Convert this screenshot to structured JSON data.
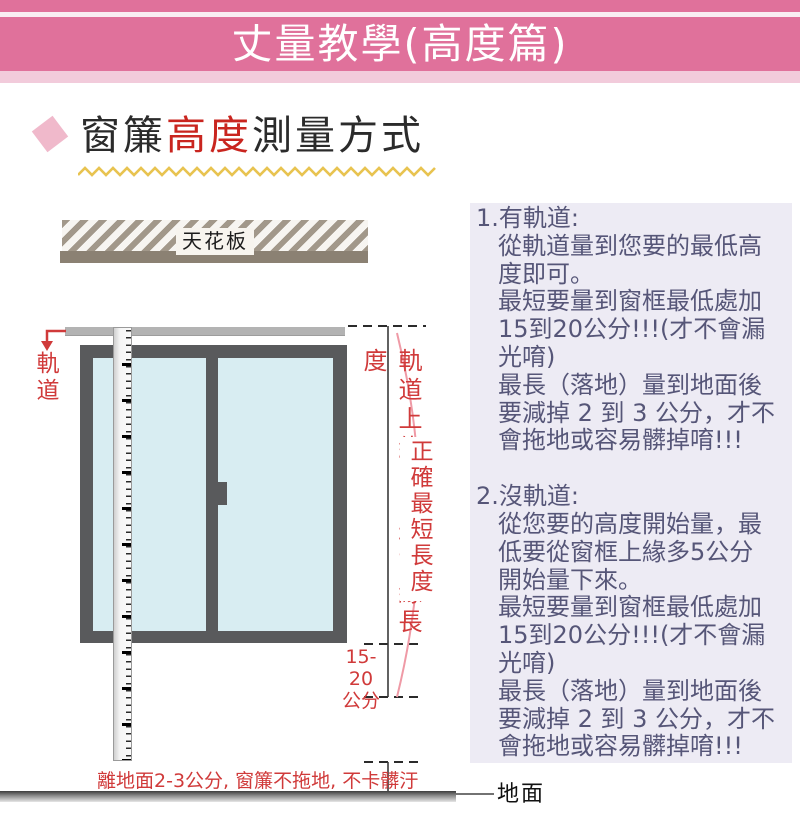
{
  "banner": {
    "title": "丈量教學(高度篇)"
  },
  "heading": {
    "part1": "窗簾",
    "highlight": "高度",
    "part2": "測量方式"
  },
  "diagram": {
    "ceiling_label": "天花板",
    "track_label": "軌道",
    "measure_left_label": "軌道上緣到窗框下緣長度",
    "measure_right_label": "正確最短長度",
    "gap_label_line1": "15-20",
    "gap_label_line2": "公分",
    "floor_note": "離地面2-3公分, 窗簾不拖地, 不卡髒汙",
    "ground_label": "地面"
  },
  "instructions": {
    "section1": {
      "heading": "1.有軌道:",
      "lines": [
        "從軌道量到您要的最低高",
        "度即可。",
        "最短要量到窗框最低處加",
        "15到20公分!!!(才不會漏",
        "光唷)",
        "最長（落地）量到地面後",
        "要減掉 2 到 3 公分，才不",
        "會拖地或容易髒掉唷!!!"
      ]
    },
    "section2": {
      "heading": "2.沒軌道:",
      "lines": [
        "從您要的高度開始量，最",
        "低要從窗框上緣多5公分",
        "開始量下來。",
        "最短要量到窗框最低處加",
        "15到20公分!!!(才不會漏",
        "光唷)",
        "最長（落地）量到地面後",
        "要減掉 2 到 3 公分，才不",
        "會拖地或容易髒掉唷!!!"
      ]
    }
  },
  "colors": {
    "banner_pink": "#e0719b",
    "banner_light_pink": "#f2cbdb",
    "accent_red": "#d03a3a",
    "heading_red": "#c9251f",
    "panel_bg": "#edebf4",
    "panel_text": "#565678",
    "zigzag_yellow": "#e8c350",
    "window_frame": "#595a5c",
    "window_glass": "#d8edf2",
    "ceiling_taupe": "#8b8173"
  }
}
